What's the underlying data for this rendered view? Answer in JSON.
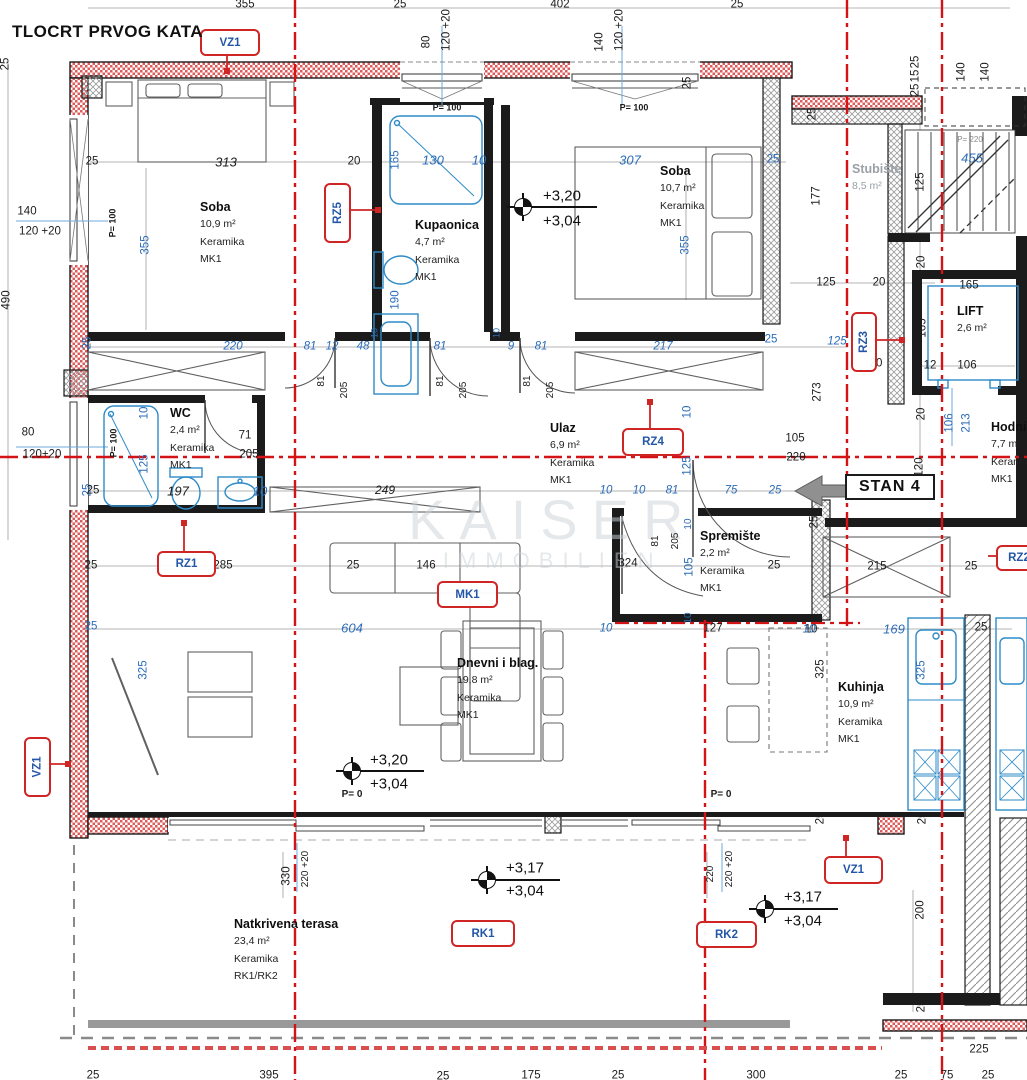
{
  "title": "TLOCRT PRVOG KATA",
  "stan_badge": "STAN 4",
  "watermark": {
    "line1": "KAISER",
    "line2": "IMMOBILIEN"
  },
  "colors": {
    "axis_red": "#d41317",
    "dim_blue": "#2b6cb8",
    "tag_border_red": "#cf2525",
    "tag_text_blue": "#2456a8",
    "wall_black": "#1b1b1b",
    "fixture_blue": "#2e8bc8"
  },
  "rooms": [
    {
      "name": "Soba",
      "area": "10,9 m²",
      "material": "Keramika",
      "code": "MK1",
      "x": 200,
      "y": 200
    },
    {
      "name": "Kupaonica",
      "area": "4,7 m²",
      "material": "Keramika",
      "code": "MK1",
      "x": 415,
      "y": 218
    },
    {
      "name": "Soba",
      "area": "10,7 m²",
      "material": "Keramika",
      "code": "MK1",
      "x": 660,
      "y": 164
    },
    {
      "name": "Stubište",
      "area": "8,5 m²",
      "x": 852,
      "y": 162,
      "muted": true
    },
    {
      "name": "LIFT",
      "area": "2,6 m²",
      "x": 957,
      "y": 304
    },
    {
      "name": "WC",
      "area": "2,4 m²",
      "material": "Keramika",
      "code": "MK1",
      "x": 170,
      "y": 406
    },
    {
      "name": "Ulaz",
      "area": "6,9 m²",
      "material": "Keramika",
      "code": "MK1",
      "x": 550,
      "y": 421
    },
    {
      "name": "Hodnik",
      "area": "7,7 m²",
      "material": "Keramika",
      "code": "MK1",
      "x": 991,
      "y": 420
    },
    {
      "name": "Spremište",
      "area": "2,2 m²",
      "material": "Keramika",
      "code": "MK1",
      "x": 700,
      "y": 529
    },
    {
      "name": "Dnevni i blag.",
      "area": "19,8 m²",
      "material": "Keramika",
      "code": "MK1",
      "x": 457,
      "y": 656
    },
    {
      "name": "Kuhinja",
      "area": "10,9 m²",
      "material": "Keramika",
      "code": "MK1",
      "x": 838,
      "y": 680
    },
    {
      "name": "Natkrivena terasa",
      "area": "23,4 m²",
      "material": "Keramika",
      "code": "RK1/RK2",
      "x": 234,
      "y": 917
    }
  ],
  "tags": [
    {
      "label": "VZ1",
      "x": 200,
      "y": 29,
      "w": 56,
      "h": 23
    },
    {
      "label": "RZ5",
      "x": 324,
      "y": 183,
      "w": 23,
      "h": 56,
      "rot": true
    },
    {
      "label": "RZ4",
      "x": 622,
      "y": 428,
      "w": 58,
      "h": 24
    },
    {
      "label": "RZ3",
      "x": 851,
      "y": 312,
      "w": 22,
      "h": 56,
      "rot": true
    },
    {
      "label": "RZ1",
      "x": 157,
      "y": 551,
      "w": 55,
      "h": 22
    },
    {
      "label": "MK1",
      "x": 437,
      "y": 581,
      "w": 57,
      "h": 23
    },
    {
      "label": "RK1",
      "x": 451,
      "y": 920,
      "w": 60,
      "h": 23
    },
    {
      "label": "RK2",
      "x": 696,
      "y": 921,
      "w": 57,
      "h": 23
    },
    {
      "label": "VZ1",
      "x": 824,
      "y": 856,
      "w": 55,
      "h": 24
    },
    {
      "label": "VZ1",
      "x": 24,
      "y": 737,
      "w": 23,
      "h": 56,
      "rot": true
    },
    {
      "label": "RZ2",
      "x": 996,
      "y": 545,
      "w": 42,
      "h": 22
    }
  ],
  "elevations": [
    {
      "upper": "+3,20",
      "lower": "+3,04",
      "sx": 523,
      "sy": 207,
      "tx": 543,
      "ty1": 196,
      "ty2": 221
    },
    {
      "upper": "+3,20",
      "lower": "+3,04",
      "sx": 352,
      "sy": 771,
      "tx": 370,
      "ty1": 760,
      "ty2": 784
    },
    {
      "upper": "+3,17",
      "lower": "+3,04",
      "sx": 487,
      "sy": 880,
      "tx": 506,
      "ty1": 868,
      "ty2": 891
    },
    {
      "upper": "+3,17",
      "lower": "+3,04",
      "sx": 765,
      "sy": 909,
      "tx": 784,
      "ty1": 897,
      "ty2": 921
    }
  ],
  "dims": [
    {
      "t": "355",
      "x": 245,
      "y": 5
    },
    {
      "t": "25",
      "x": 400,
      "y": 5
    },
    {
      "t": "402",
      "x": 560,
      "y": 5
    },
    {
      "t": "25",
      "x": 737,
      "y": 5
    },
    {
      "t": "80",
      "x": 427,
      "y": 42,
      "r": 1
    },
    {
      "t": "120 +20",
      "x": 447,
      "y": 30,
      "r": 1
    },
    {
      "t": "140",
      "x": 600,
      "y": 42,
      "r": 1
    },
    {
      "t": "120 +20",
      "x": 620,
      "y": 30,
      "r": 1
    },
    {
      "t": "25",
      "x": 916,
      "y": 62,
      "r": 1
    },
    {
      "t": "15",
      "x": 916,
      "y": 76,
      "r": 1
    },
    {
      "t": "25",
      "x": 916,
      "y": 90,
      "r": 1
    },
    {
      "t": "140",
      "x": 962,
      "y": 72,
      "r": 1
    },
    {
      "t": "140",
      "x": 986,
      "y": 72,
      "r": 1
    },
    {
      "t": "25",
      "x": 6,
      "y": 64,
      "r": 1
    },
    {
      "t": "490",
      "x": 7,
      "y": 300,
      "r": 1
    },
    {
      "t": "140",
      "x": 27,
      "y": 212
    },
    {
      "t": "120 +20",
      "x": 40,
      "y": 232
    },
    {
      "t": "80",
      "x": 28,
      "y": 433
    },
    {
      "t": "120+20",
      "x": 42,
      "y": 455
    },
    {
      "t": "25",
      "x": 88,
      "y": 343,
      "c": "u",
      "r": 1
    },
    {
      "t": "25",
      "x": 88,
      "y": 490,
      "c": "u",
      "r": 1
    },
    {
      "t": "313",
      "x": 226,
      "y": 162,
      "i": 1,
      "s": 13
    },
    {
      "t": "25",
      "x": 92,
      "y": 162
    },
    {
      "t": "20",
      "x": 354,
      "y": 162
    },
    {
      "t": "355",
      "x": 146,
      "y": 245,
      "c": "u",
      "r": 1
    },
    {
      "t": "P= 100",
      "x": 113,
      "y": 223,
      "r": 1,
      "b": 1,
      "s": 9
    },
    {
      "t": "165",
      "x": 396,
      "y": 160,
      "c": "u",
      "r": 1
    },
    {
      "t": "130",
      "x": 433,
      "y": 160,
      "c": "u",
      "i": 1,
      "s": 13
    },
    {
      "t": "10",
      "x": 479,
      "y": 160,
      "c": "u",
      "i": 1,
      "s": 13
    },
    {
      "t": "190",
      "x": 396,
      "y": 300,
      "c": "u",
      "r": 1
    },
    {
      "t": "P= 100",
      "x": 447,
      "y": 108,
      "b": 1,
      "s": 9
    },
    {
      "t": "P= 100",
      "x": 634,
      "y": 108,
      "b": 1,
      "s": 9
    },
    {
      "t": "307",
      "x": 630,
      "y": 160,
      "c": "u",
      "i": 1,
      "s": 13
    },
    {
      "t": "25",
      "x": 773,
      "y": 160,
      "c": "u"
    },
    {
      "t": "355",
      "x": 686,
      "y": 245,
      "c": "u",
      "r": 1
    },
    {
      "t": "25",
      "x": 688,
      "y": 83,
      "r": 1
    },
    {
      "t": "25",
      "x": 813,
      "y": 114,
      "r": 1
    },
    {
      "t": "177",
      "x": 817,
      "y": 196,
      "r": 1
    },
    {
      "t": "125",
      "x": 921,
      "y": 182,
      "r": 1
    },
    {
      "t": "455",
      "x": 972,
      "y": 158,
      "c": "u",
      "i": 1,
      "s": 13
    },
    {
      "t": "P= 220",
      "x": 970,
      "y": 140,
      "c": "g",
      "s": 8
    },
    {
      "t": "125",
      "x": 826,
      "y": 283
    },
    {
      "t": "20",
      "x": 879,
      "y": 283
    },
    {
      "t": "165",
      "x": 969,
      "y": 286
    },
    {
      "t": "165",
      "x": 923,
      "y": 328,
      "r": 1
    },
    {
      "t": "20",
      "x": 922,
      "y": 262,
      "r": 1
    },
    {
      "t": "12",
      "x": 930,
      "y": 366
    },
    {
      "t": "106",
      "x": 967,
      "y": 366
    },
    {
      "t": "20",
      "x": 922,
      "y": 414,
      "r": 1
    },
    {
      "t": "106",
      "x": 950,
      "y": 423,
      "c": "u",
      "r": 1
    },
    {
      "t": "213",
      "x": 967,
      "y": 423,
      "c": "u",
      "r": 1
    },
    {
      "t": "120",
      "x": 920,
      "y": 467,
      "r": 1
    },
    {
      "t": "25",
      "x": 771,
      "y": 340,
      "c": "u"
    },
    {
      "t": "125",
      "x": 837,
      "y": 342,
      "c": "u",
      "i": 1
    },
    {
      "t": "20",
      "x": 876,
      "y": 364
    },
    {
      "t": "273",
      "x": 818,
      "y": 392,
      "r": 1
    },
    {
      "t": "105",
      "x": 795,
      "y": 439
    },
    {
      "t": "220",
      "x": 796,
      "y": 458,
      "k": 1
    },
    {
      "t": "220",
      "x": 233,
      "y": 347,
      "c": "u",
      "i": 1
    },
    {
      "t": "81",
      "x": 310,
      "y": 347,
      "c": "u",
      "i": 1
    },
    {
      "t": "12",
      "x": 332,
      "y": 347,
      "c": "u",
      "i": 1
    },
    {
      "t": "48",
      "x": 363,
      "y": 347,
      "c": "u",
      "i": 1
    },
    {
      "t": "81",
      "x": 440,
      "y": 347,
      "c": "u",
      "i": 1
    },
    {
      "t": "9",
      "x": 511,
      "y": 347,
      "c": "u",
      "i": 1
    },
    {
      "t": "81",
      "x": 541,
      "y": 347,
      "c": "u",
      "i": 1
    },
    {
      "t": "217",
      "x": 663,
      "y": 347,
      "c": "u",
      "i": 1
    },
    {
      "t": "10",
      "x": 375,
      "y": 333,
      "c": "u",
      "r": 1,
      "s": 9
    },
    {
      "t": "10",
      "x": 497,
      "y": 333,
      "c": "u",
      "r": 1,
      "s": 9
    },
    {
      "t": "81",
      "x": 322,
      "y": 381,
      "r": 1,
      "s": 10
    },
    {
      "t": "205",
      "x": 345,
      "y": 390,
      "r": 1,
      "s": 10
    },
    {
      "t": "81",
      "x": 441,
      "y": 381,
      "r": 1,
      "s": 10
    },
    {
      "t": "205",
      "x": 464,
      "y": 390,
      "r": 1,
      "s": 10
    },
    {
      "t": "81",
      "x": 528,
      "y": 381,
      "r": 1,
      "s": 10
    },
    {
      "t": "205",
      "x": 551,
      "y": 390,
      "r": 1,
      "s": 10
    },
    {
      "t": "10",
      "x": 145,
      "y": 413,
      "c": "u",
      "r": 1
    },
    {
      "t": "125",
      "x": 145,
      "y": 464,
      "c": "u",
      "r": 1
    },
    {
      "t": "71",
      "x": 245,
      "y": 436
    },
    {
      "t": "205",
      "x": 249,
      "y": 455
    },
    {
      "t": "25",
      "x": 93,
      "y": 491
    },
    {
      "t": "197",
      "x": 178,
      "y": 491,
      "i": 1,
      "s": 13
    },
    {
      "t": "10",
      "x": 260,
      "y": 491,
      "c": "u",
      "i": 1,
      "s": 13
    },
    {
      "t": "P= 100",
      "x": 114,
      "y": 443,
      "r": 1,
      "b": 1,
      "s": 9
    },
    {
      "t": "249",
      "x": 385,
      "y": 490,
      "i": 1,
      "s": 12
    },
    {
      "t": "10",
      "x": 606,
      "y": 491,
      "c": "u",
      "i": 1
    },
    {
      "t": "10",
      "x": 639,
      "y": 491,
      "c": "u",
      "i": 1
    },
    {
      "t": "81",
      "x": 672,
      "y": 491,
      "c": "u",
      "i": 1
    },
    {
      "t": "75",
      "x": 731,
      "y": 491,
      "c": "u",
      "i": 1
    },
    {
      "t": "25",
      "x": 775,
      "y": 491,
      "c": "u",
      "i": 1
    },
    {
      "t": "10",
      "x": 688,
      "y": 412,
      "c": "u",
      "r": 1
    },
    {
      "t": "125",
      "x": 688,
      "y": 466,
      "c": "u",
      "r": 1
    },
    {
      "t": "324",
      "x": 628,
      "y": 564
    },
    {
      "t": "25",
      "x": 774,
      "y": 566
    },
    {
      "t": "81",
      "x": 656,
      "y": 541,
      "r": 1,
      "s": 10
    },
    {
      "t": "205",
      "x": 676,
      "y": 541,
      "r": 1,
      "s": 10
    },
    {
      "t": "10",
      "x": 689,
      "y": 524,
      "c": "u",
      "r": 1,
      "s": 10
    },
    {
      "t": "105",
      "x": 690,
      "y": 567,
      "c": "u",
      "r": 1
    },
    {
      "t": "10",
      "x": 689,
      "y": 618,
      "c": "u",
      "r": 1,
      "s": 10
    },
    {
      "t": "127",
      "x": 713,
      "y": 629
    },
    {
      "t": "10",
      "x": 811,
      "y": 630
    },
    {
      "t": "215",
      "x": 877,
      "y": 567
    },
    {
      "t": "25",
      "x": 971,
      "y": 567
    },
    {
      "t": "25",
      "x": 815,
      "y": 522,
      "r": 1
    },
    {
      "t": "25",
      "x": 91,
      "y": 566
    },
    {
      "t": "285",
      "x": 223,
      "y": 566
    },
    {
      "t": "25",
      "x": 353,
      "y": 566
    },
    {
      "t": "146",
      "x": 426,
      "y": 566
    },
    {
      "t": "604",
      "x": 352,
      "y": 628,
      "c": "u",
      "i": 1,
      "s": 13
    },
    {
      "t": "25",
      "x": 91,
      "y": 627,
      "c": "u"
    },
    {
      "t": "325",
      "x": 144,
      "y": 670,
      "c": "u",
      "r": 1
    },
    {
      "t": "10",
      "x": 606,
      "y": 629,
      "c": "u",
      "i": 1
    },
    {
      "t": "10",
      "x": 809,
      "y": 630,
      "c": "u",
      "i": 1
    },
    {
      "t": "169",
      "x": 894,
      "y": 629,
      "c": "u",
      "i": 1,
      "s": 13
    },
    {
      "t": "25",
      "x": 981,
      "y": 628
    },
    {
      "t": "325",
      "x": 821,
      "y": 669,
      "r": 1
    },
    {
      "t": "325",
      "x": 922,
      "y": 670,
      "c": "u",
      "r": 1
    },
    {
      "t": "25",
      "x": 821,
      "y": 818,
      "r": 1
    },
    {
      "t": "25",
      "x": 923,
      "y": 818,
      "r": 1
    },
    {
      "t": "P= 0",
      "x": 352,
      "y": 795,
      "b": 1,
      "s": 10
    },
    {
      "t": "P= 0",
      "x": 721,
      "y": 795,
      "b": 1,
      "s": 10
    },
    {
      "t": "330",
      "x": 287,
      "y": 876,
      "r": 1
    },
    {
      "t": "220 +20",
      "x": 306,
      "y": 869,
      "r": 1,
      "s": 10
    },
    {
      "t": "220",
      "x": 711,
      "y": 874,
      "r": 1,
      "s": 10
    },
    {
      "t": "220 +20",
      "x": 730,
      "y": 869,
      "r": 1,
      "s": 10
    },
    {
      "t": "200",
      "x": 921,
      "y": 910,
      "r": 1
    },
    {
      "t": "25",
      "x": 922,
      "y": 1006,
      "r": 1
    },
    {
      "t": "225",
      "x": 979,
      "y": 1050
    },
    {
      "t": "300",
      "x": 756,
      "y": 1076
    },
    {
      "t": "25",
      "x": 93,
      "y": 1076
    },
    {
      "t": "395",
      "x": 269,
      "y": 1076
    },
    {
      "t": "25",
      "x": 443,
      "y": 1077
    },
    {
      "t": "175",
      "x": 531,
      "y": 1076
    },
    {
      "t": "25",
      "x": 618,
      "y": 1076
    },
    {
      "t": "25",
      "x": 901,
      "y": 1076
    },
    {
      "t": "75",
      "x": 947,
      "y": 1076
    },
    {
      "t": "25",
      "x": 988,
      "y": 1076
    }
  ]
}
